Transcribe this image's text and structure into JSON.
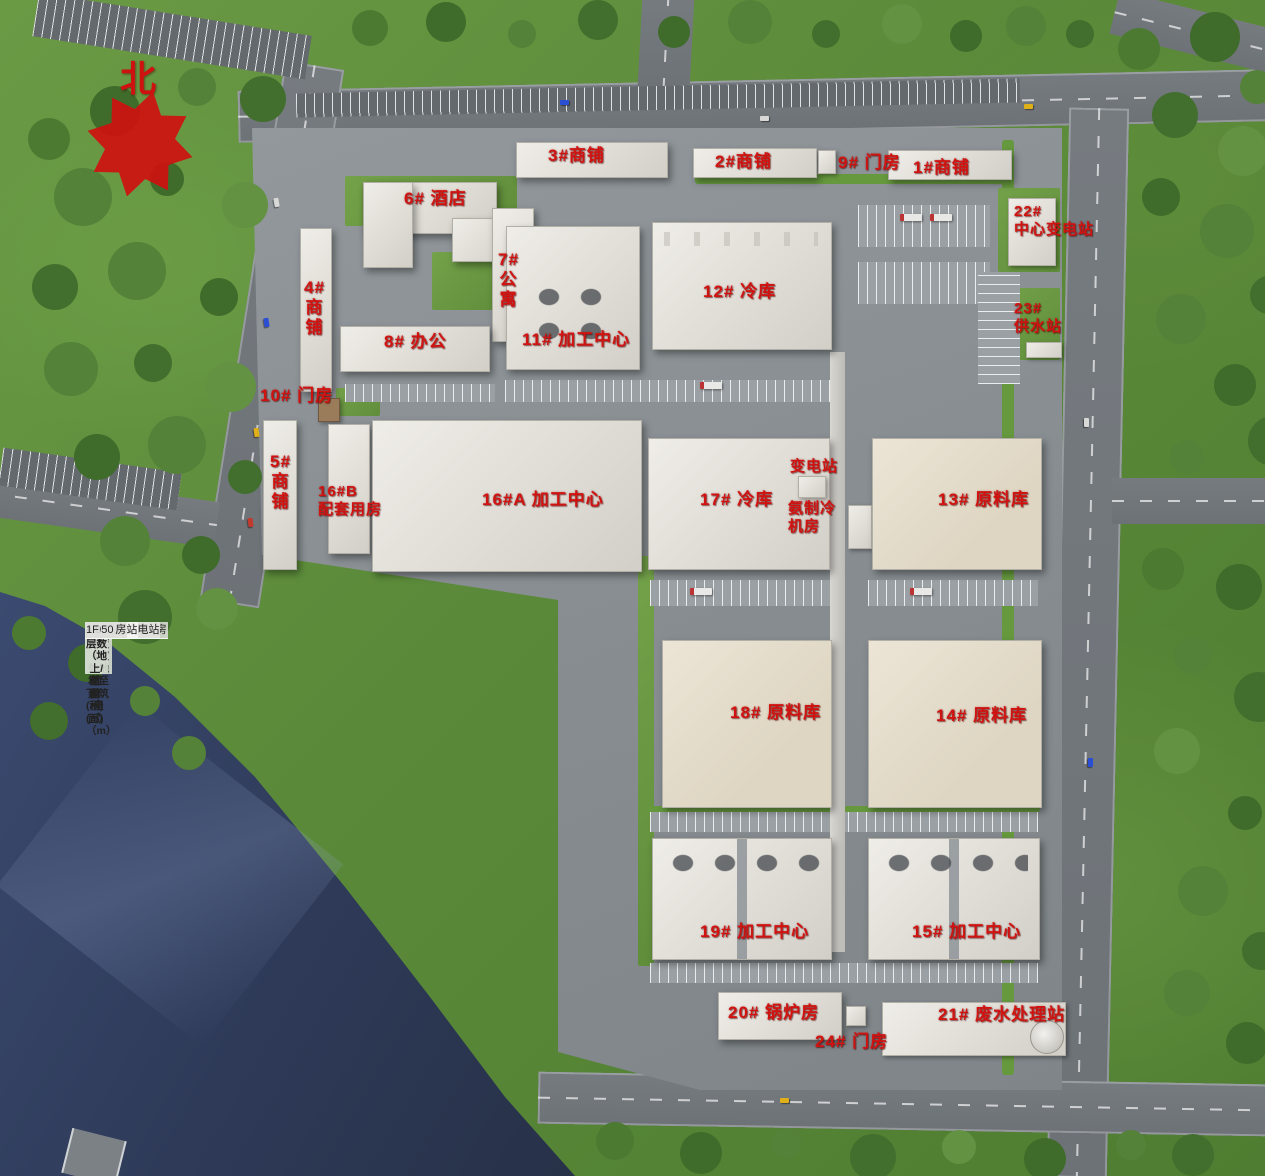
{
  "north": {
    "label": "北"
  },
  "labels": {
    "shop3": "3#商铺",
    "shop2": "2#商铺",
    "gate9": "9# 门房",
    "shop1": "1#商铺",
    "hotel6": "6# 酒店",
    "apt7": "7#\n公\n寓",
    "shop4": "4#\n商\n铺",
    "office8": "8# 办公",
    "proc11": "11# 加工中心",
    "cold12": "12# 冷库",
    "sub22": "22#\n中心变电站",
    "water23": "23#\n供水站",
    "gate10": "10# 门房",
    "shop5": "5#\n商\n铺",
    "b16B": "16#B\n配套用房",
    "b16A": "16#A 加工中心",
    "cold17": "17# 冷库",
    "substation": "变电站",
    "ammonia": "氨制冷\n机房",
    "raw13": "13# 原料库",
    "raw18": "18# 原料库",
    "raw14": "14# 原料库",
    "proc19": "19# 加工中心",
    "proc15": "15# 加工中心",
    "boiler20": "20# 锅炉房",
    "waste21": "21# 废水处理站",
    "gate24": "24# 门房"
  },
  "table": {
    "headers": [
      "序号",
      "建筑名称",
      "建筑单体总面积(㎡)",
      "建筑占地面积(㎡)",
      "建筑高度（室外地坪至建筑屋面）（m）",
      "建筑层数（地上/地下）"
    ],
    "rows": [
      [
        "1",
        "1#商铺",
        "3075.00",
        "1025.00",
        "13.85",
        "3F/0"
      ],
      [
        "2",
        "2#商铺",
        "3075.00",
        "1025.00",
        "13.85",
        "3F/0"
      ],
      [
        "3",
        "3#商铺",
        "3729.00",
        "1243.00",
        "13.85",
        "3F/0"
      ],
      [
        "4",
        "4#商铺",
        "3090.00",
        "1030.00",
        "13.85",
        "3F/0"
      ],
      [
        "5",
        "5#商铺",
        "3090.00",
        "1030.00",
        "13.85",
        "3F/0"
      ],
      [
        "6",
        "6#酒店",
        "20196.00",
        "3230.00",
        "39.65",
        "9F/1D"
      ],
      [
        "7",
        "7#公寓楼",
        "8745.68",
        "1420.80",
        "26.35",
        "6F/1D"
      ],
      [
        "8",
        "8#办公楼",
        "11347.32",
        "1064.44",
        "26.35",
        "6F/1D"
      ],
      [
        "9",
        "9#门房",
        "63.00",
        "63.00",
        "4.95",
        "1F"
      ],
      [
        "10",
        "10#门房",
        "63.00",
        "63.00",
        "4.95",
        "1F"
      ],
      [
        "11",
        "11#加工中心",
        "13586",
        "6530.00",
        "14.20",
        "2F/1D"
      ],
      [
        "12",
        "12#冷库",
        "14663",
        "9628.00",
        "16.25",
        "1F"
      ],
      [
        "13",
        "13#原料库",
        "48233",
        "8589.00",
        "38.40",
        "6F/1D"
      ],
      [
        "14",
        "14#原料库",
        "49535",
        "8589.00",
        "38.40",
        "6F/1D"
      ],
      [
        "15",
        "15#加工中心",
        "38783",
        "8696.00",
        "23.99",
        "4F/1D"
      ],
      [
        "16",
        "16#A加工中心",
        "13126",
        "10901.00",
        "13.00",
        "2F"
      ],
      [
        "17",
        "16#B配套用房",
        "2268.00",
        "1056.00",
        "10.70",
        "2F"
      ],
      [
        "18",
        "17#冷库",
        "13004",
        "8313.00",
        "16.25",
        "1F"
      ],
      [
        "19",
        "17A#氨制冷机房",
        "912",
        "912.00",
        "10.45",
        "1F"
      ],
      [
        "20",
        "17B#变电站",
        "436",
        "436.00",
        "5.95",
        "1F"
      ],
      [
        "21",
        "18#原料库",
        "49664",
        "8589.00",
        "38.40",
        "6F/1D"
      ],
      [
        "22",
        "19#加工中心",
        "36713",
        "8696.00",
        "23.99",
        "4F/1D"
      ],
      [
        "23",
        "20#锅炉房",
        "1653.00",
        "1653.00",
        "9.45",
        "1F"
      ],
      [
        "24",
        "21#废水处理站",
        "2773.00",
        "1819.00",
        "7.95",
        "1F/1D"
      ],
      [
        "25",
        "22#中心变电站",
        "833.07",
        "529.86",
        "10.45",
        "2/0"
      ],
      [
        "26",
        "23#供水站",
        "415.00",
        "25.00",
        "3.70",
        "1F/1D"
      ],
      [
        "27",
        "24#门房",
        "63.00",
        "63.00",
        "4.95",
        "1F"
      ]
    ]
  },
  "colors": {
    "label_red": "#d01310",
    "water": "#2e3a58",
    "road": "#74797d",
    "grass": "#5f8d3c",
    "building": "#e3e0d9"
  }
}
